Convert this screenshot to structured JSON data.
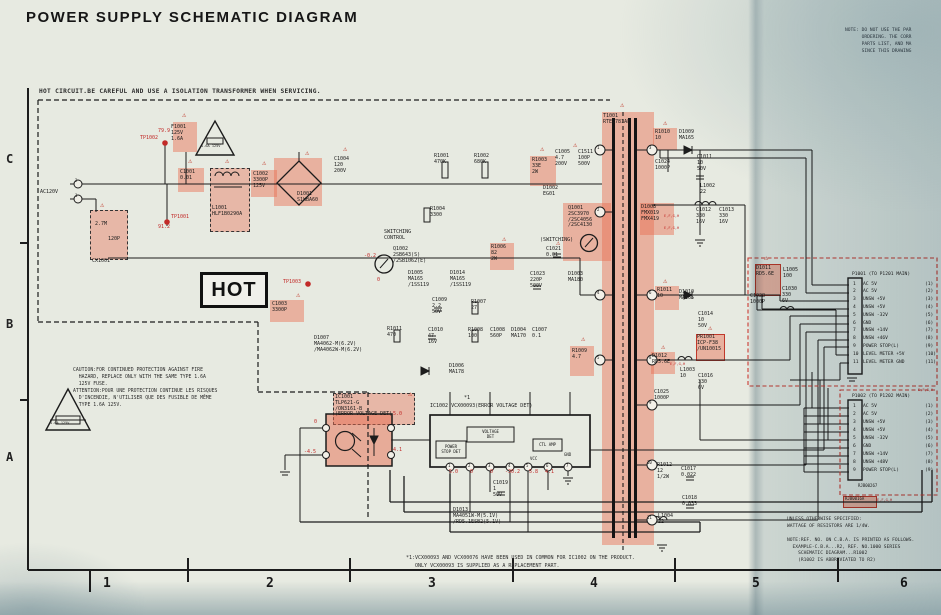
{
  "title": "POWER SUPPLY SCHEMATIC DIAGRAM",
  "corner_note": "NOTE: DO NOT USE THE PAR\n      ORDERING. THE CORR\n      PARTS LIST, AND MA\n      SINCE THIS DRAWING",
  "hot_warning": "HOT CIRCUIT.BE CAREFUL AND USE A ISOLATION TRANSFORMER WHEN SERVICING.",
  "hot_label": "HOT",
  "caution_note": "CAUTION:FOR CONTINUED PROTECTION AGAINST FIRE\n  HAZARD, REPLACE ONLY WITH THE SAME TYPE 1.6A\n  125V FUSE.\nATTENTION:POUR UNE PROTECTION CONTINUE LES RISQUES\n  D'INCENDIE, N'UTILISER QUE DES FUSIBLE DE MÊME\n  TYPE 1.6A 125V.",
  "right_notes": "UNLESS OTHERWISE SPECIFIED:\nWATTAGE OF RESISTORS ARE 1/4W.\n\nNOTE:REF. NO. ON C.B.A. IS PRINTED AS FOLLOWS.\n  EXAMPLE-C.B.A...R2, REF. NO.1000 SERIES\n    SCHEMATIC DIAGRAM...R1002\n    (R1002 IS ABBREVIATED TO R2)",
  "footnote": "*1:VCX00093 AND VCX00076 HAVE BEEN USED IN COMMON FOR IC1002 ON THE PRODUCT.\n   ONLY VCX00093 IS SUPPLIED AS A REPLACEMENT PART.",
  "colors": {
    "highlight": "#e86c50",
    "red_annotation": "#c22a28",
    "red_dashed_box": "#cc3b33",
    "paper": "#e7eae1",
    "line": "#1c1c1c"
  },
  "grid": {
    "rows": [
      "C",
      "B",
      "A"
    ],
    "cols": [
      "1",
      "2",
      "3",
      "4",
      "5",
      "6"
    ]
  },
  "ic1002": {
    "power_stop": "POWER\nSTOP DET",
    "voltage_det": "VOLTAGE\nDET",
    "ctl_amp": "CTL AMP",
    "vcc": "VCC",
    "gnd": "GND"
  },
  "connectors": [
    {
      "header": "P1001 (TO P1201 MAIN)",
      "pins": [
        {
          "n": "1",
          "label": "AC 5V",
          "ref": "(1)"
        },
        {
          "n": "2",
          "label": "AC 5V",
          "ref": "(2)"
        },
        {
          "n": "3",
          "label": "UNSW +5V",
          "ref": "(3)"
        },
        {
          "n": "4",
          "label": "UNSW +5V",
          "ref": "(4)"
        },
        {
          "n": "5",
          "label": "UNSW -32V",
          "ref": "(5)"
        },
        {
          "n": "6",
          "label": "GND",
          "ref": "(6)"
        },
        {
          "n": "7",
          "label": "UNSW +14V",
          "ref": "(7)"
        },
        {
          "n": "8",
          "label": "UNSW +46V",
          "ref": "(8)"
        },
        {
          "n": "9",
          "label": "POWER STOP(L)",
          "ref": "(9)"
        },
        {
          "n": "10",
          "label": "LEVEL METER +5V",
          "ref": "(10)"
        },
        {
          "n": "11",
          "label": "LEVEL METER GND",
          "ref": "(11)"
        }
      ]
    },
    {
      "header": "P1002 (TO P1202 MAIN)",
      "pins": [
        {
          "n": "1",
          "label": "AC 5V",
          "ref": "(1)"
        },
        {
          "n": "2",
          "label": "AC 5V",
          "ref": "(2)"
        },
        {
          "n": "3",
          "label": "UNSW +5V",
          "ref": "(3)"
        },
        {
          "n": "4",
          "label": "UNSW +5V",
          "ref": "(4)"
        },
        {
          "n": "5",
          "label": "UNSW -32V",
          "ref": "(5)"
        },
        {
          "n": "6",
          "label": "GND",
          "ref": "(6)"
        },
        {
          "n": "7",
          "label": "UNSW +14V",
          "ref": "(7)"
        },
        {
          "n": "8",
          "label": "UNSW +48V",
          "ref": "(8)"
        },
        {
          "n": "9",
          "label": "POWER STOP(L)",
          "ref": "(9)"
        }
      ]
    }
  ],
  "highlights": [
    {
      "x": 173,
      "y": 122,
      "w": 24,
      "h": 30
    },
    {
      "x": 178,
      "y": 168,
      "w": 26,
      "h": 24
    },
    {
      "x": 210,
      "y": 168,
      "w": 38,
      "h": 62,
      "bk": 1
    },
    {
      "x": 251,
      "y": 170,
      "w": 26,
      "h": 27
    },
    {
      "x": 274,
      "y": 158,
      "w": 48,
      "h": 48
    },
    {
      "x": 90,
      "y": 210,
      "w": 36,
      "h": 48,
      "bk": 1
    },
    {
      "x": 530,
      "y": 156,
      "w": 26,
      "h": 30
    },
    {
      "x": 563,
      "y": 203,
      "w": 48,
      "h": 58
    },
    {
      "x": 490,
      "y": 243,
      "w": 24,
      "h": 27
    },
    {
      "x": 270,
      "y": 300,
      "w": 34,
      "h": 22
    },
    {
      "x": 570,
      "y": 346,
      "w": 24,
      "h": 30
    },
    {
      "x": 653,
      "y": 128,
      "w": 24,
      "h": 22
    },
    {
      "x": 640,
      "y": 203,
      "w": 34,
      "h": 32
    },
    {
      "x": 655,
      "y": 286,
      "w": 24,
      "h": 24
    },
    {
      "x": 651,
      "y": 352,
      "w": 24,
      "h": 22
    },
    {
      "x": 696,
      "y": 334,
      "w": 27,
      "h": 25,
      "bd": 1
    },
    {
      "x": 755,
      "y": 264,
      "w": 24,
      "h": 30,
      "bd": 1
    },
    {
      "x": 333,
      "y": 393,
      "w": 80,
      "h": 30,
      "bk": 1
    },
    {
      "x": 602,
      "y": 112,
      "w": 52,
      "h": 433
    },
    {
      "x": 843,
      "y": 496,
      "w": 32,
      "h": 10,
      "bd": 1
    }
  ],
  "warning_triangles": [
    {
      "x": 182,
      "y": 112
    },
    {
      "x": 188,
      "y": 158
    },
    {
      "x": 225,
      "y": 158
    },
    {
      "x": 262,
      "y": 160
    },
    {
      "x": 305,
      "y": 150
    },
    {
      "x": 343,
      "y": 146
    },
    {
      "x": 100,
      "y": 202
    },
    {
      "x": 540,
      "y": 146
    },
    {
      "x": 573,
      "y": 142
    },
    {
      "x": 502,
      "y": 236
    },
    {
      "x": 296,
      "y": 292
    },
    {
      "x": 581,
      "y": 336
    },
    {
      "x": 663,
      "y": 120
    },
    {
      "x": 663,
      "y": 278
    },
    {
      "x": 661,
      "y": 344
    },
    {
      "x": 708,
      "y": 325
    },
    {
      "x": 764,
      "y": 255
    },
    {
      "x": 408,
      "y": 391
    },
    {
      "x": 556,
      "y": 240
    },
    {
      "x": 620,
      "y": 102
    }
  ],
  "labels": [
    {
      "x": 40,
      "y": 190,
      "t": "AC120V"
    },
    {
      "x": 75,
      "y": 179,
      "t": "2",
      "s": 4
    },
    {
      "x": 75,
      "y": 194,
      "t": "1",
      "s": 4
    },
    {
      "x": 171,
      "y": 125,
      "t": "F1001\n125V\n1.6A"
    },
    {
      "x": 201,
      "y": 144,
      "t": "1.6A 125V",
      "s": 35
    },
    {
      "x": 180,
      "y": 170,
      "t": "C1001\n0.01"
    },
    {
      "x": 212,
      "y": 206,
      "t": "L1001\nHLF1B0290A"
    },
    {
      "x": 253,
      "y": 172,
      "t": "C1002\n3300P\n125V"
    },
    {
      "x": 297,
      "y": 192,
      "t": "D1001\nS1WBA60"
    },
    {
      "x": 334,
      "y": 157,
      "t": "C1004\n120\n200V"
    },
    {
      "x": 95,
      "y": 222,
      "t": "2.7M"
    },
    {
      "x": 108,
      "y": 237,
      "t": "120P"
    },
    {
      "x": 92,
      "y": 259,
      "t": "CX1001"
    },
    {
      "x": 434,
      "y": 154,
      "t": "R1001\n470K"
    },
    {
      "x": 474,
      "y": 154,
      "t": "R1002\n680K"
    },
    {
      "x": 532,
      "y": 158,
      "t": "R1003\n33E\n2W"
    },
    {
      "x": 555,
      "y": 150,
      "t": "C1005\n4.7\n200V"
    },
    {
      "x": 578,
      "y": 150,
      "t": "C1511\n100P\n500V"
    },
    {
      "x": 543,
      "y": 186,
      "t": "D1002\nEG01"
    },
    {
      "x": 568,
      "y": 206,
      "t": "Q1001\n2SC3970\n/2SC4056\n/2SC4130"
    },
    {
      "x": 540,
      "y": 238,
      "t": "(SWITCHING)"
    },
    {
      "x": 430,
      "y": 207,
      "t": "R1004\n3300"
    },
    {
      "x": 384,
      "y": 230,
      "t": "SWITCHING\nCONTROL"
    },
    {
      "x": 393,
      "y": 247,
      "t": "Q1002\n2SB643(S)\n/2SB1062(E)"
    },
    {
      "x": 408,
      "y": 271,
      "t": "D1005\nMA165\n/1SS119"
    },
    {
      "x": 450,
      "y": 271,
      "t": "D1014\nMA165\n/1SS119"
    },
    {
      "x": 491,
      "y": 245,
      "t": "R1006\n82\n2W"
    },
    {
      "x": 432,
      "y": 298,
      "t": "C1009\n2.2\n50V"
    },
    {
      "x": 471,
      "y": 300,
      "t": "R1007\n27"
    },
    {
      "x": 428,
      "y": 328,
      "t": "C1010\n47\n16V"
    },
    {
      "x": 468,
      "y": 328,
      "t": "R1008\n100"
    },
    {
      "x": 490,
      "y": 328,
      "t": "C1008\n560P"
    },
    {
      "x": 511,
      "y": 328,
      "t": "D1004\nMA170"
    },
    {
      "x": 532,
      "y": 328,
      "t": "C1007\n0.1"
    },
    {
      "x": 449,
      "y": 364,
      "t": "D1006\nMA178"
    },
    {
      "x": 572,
      "y": 349,
      "t": "R1009\n4.7"
    },
    {
      "x": 387,
      "y": 327,
      "t": "R1011\n470"
    },
    {
      "x": 314,
      "y": 336,
      "t": "D1007\nMA4062-M(6.2V)\n/MA4062W-M(6.2V)"
    },
    {
      "x": 272,
      "y": 302,
      "t": "C1003\n3300P"
    },
    {
      "x": 546,
      "y": 247,
      "t": "C1021\n0.01"
    },
    {
      "x": 530,
      "y": 272,
      "t": "C1023\n220P\n500V"
    },
    {
      "x": 568,
      "y": 272,
      "t": "D1003\nMA180"
    },
    {
      "x": 603,
      "y": 114,
      "t": "T1001\nRTE1781AF"
    },
    {
      "x": 655,
      "y": 130,
      "t": "R1010\n10"
    },
    {
      "x": 679,
      "y": 130,
      "t": "D1009\nMA165"
    },
    {
      "x": 697,
      "y": 155,
      "t": "C1011\n10\n50V"
    },
    {
      "x": 655,
      "y": 160,
      "t": "C1024\n1000P"
    },
    {
      "x": 700,
      "y": 184,
      "t": "L1002\n22"
    },
    {
      "x": 696,
      "y": 208,
      "t": "C1012\n330\n16V"
    },
    {
      "x": 719,
      "y": 208,
      "t": "C1013\n330\n16V"
    },
    {
      "x": 641,
      "y": 205,
      "t": "D1008\nFMX019\nFMX419"
    },
    {
      "x": 664,
      "y": 214,
      "t": "E,F,G,H",
      "c": 1,
      "s": 35
    },
    {
      "x": 664,
      "y": 226,
      "t": "E,F,G,H",
      "c": 1,
      "s": 35
    },
    {
      "x": 657,
      "y": 288,
      "t": "R1011\n10"
    },
    {
      "x": 679,
      "y": 290,
      "t": "D1010\nMA165"
    },
    {
      "x": 698,
      "y": 312,
      "t": "C1014\n10\n50V"
    },
    {
      "x": 697,
      "y": 335,
      "t": "PR1001\nICP-F38\n/UN10015"
    },
    {
      "x": 652,
      "y": 354,
      "t": "D1012\nRD5.6E"
    },
    {
      "x": 670,
      "y": 362,
      "t": "E,F,G,H",
      "c": 1,
      "s": 35
    },
    {
      "x": 680,
      "y": 368,
      "t": "L1003\n10"
    },
    {
      "x": 698,
      "y": 374,
      "t": "C1016\n330\n6V"
    },
    {
      "x": 654,
      "y": 390,
      "t": "C1025\n1000P"
    },
    {
      "x": 756,
      "y": 266,
      "t": "D1011\nRD5.6E"
    },
    {
      "x": 783,
      "y": 268,
      "t": "L1005\n100"
    },
    {
      "x": 782,
      "y": 287,
      "t": "C1030\n330\n6V"
    },
    {
      "x": 750,
      "y": 294,
      "t": "C1028\n1000P"
    },
    {
      "x": 657,
      "y": 463,
      "t": "R1012\n12\n1/2W"
    },
    {
      "x": 681,
      "y": 467,
      "t": "C1017\n0.022"
    },
    {
      "x": 682,
      "y": 496,
      "t": "C1018\n0.033"
    },
    {
      "x": 658,
      "y": 514,
      "t": "L1004\n22"
    },
    {
      "x": 453,
      "y": 508,
      "t": "D1013\nMA4051W-M(5.1V)\n/RD5.1ESB2(5.1V)"
    },
    {
      "x": 493,
      "y": 481,
      "t": "C1019\n1\n50V"
    },
    {
      "x": 335,
      "y": 395,
      "t": "IC1001\nTLP621-G\n/ON3161-B\n(ERROR VOLTAGE DET)"
    },
    {
      "x": 430,
      "y": 404,
      "t": "IC1002 VCX00093(ERROR VOLTAGE DET)"
    },
    {
      "x": 464,
      "y": 396,
      "t": "*1"
    },
    {
      "x": 858,
      "y": 484,
      "t": "RJB00267",
      "s": 4
    },
    {
      "x": 845,
      "y": 497,
      "t": "RJB0016A",
      "s": 4
    },
    {
      "x": 877,
      "y": 498,
      "t": "E,F,G,H",
      "c": 1,
      "s": 35
    },
    {
      "x": 918,
      "y": 388,
      "t": "E,F,G,H",
      "c": 1,
      "s": 35
    },
    {
      "x": 50,
      "y": 421,
      "t": "1.6A 125V",
      "s": 35
    },
    {
      "x": 140,
      "y": 136,
      "t": "TP1002",
      "c": 1
    },
    {
      "x": 158,
      "y": 129,
      "t": "79.9",
      "c": 1
    },
    {
      "x": 171,
      "y": 215,
      "t": "TP1001",
      "c": 1
    },
    {
      "x": 158,
      "y": 225,
      "t": "91.2",
      "c": 1
    },
    {
      "x": 283,
      "y": 280,
      "t": "TP1003",
      "c": 1
    },
    {
      "x": 364,
      "y": 254,
      "t": "-0.2",
      "c": 1
    },
    {
      "x": 377,
      "y": 278,
      "t": "0",
      "c": 1
    },
    {
      "x": 449,
      "y": 470,
      "t": "5.0",
      "c": 1
    },
    {
      "x": 470,
      "y": 470,
      "t": "0",
      "c": 1
    },
    {
      "x": 490,
      "y": 470,
      "t": "0",
      "c": 1
    },
    {
      "x": 505,
      "y": 470,
      "t": "-30.2",
      "c": 1
    },
    {
      "x": 529,
      "y": 470,
      "t": "5.8",
      "c": 1
    },
    {
      "x": 545,
      "y": 470,
      "t": "4.1",
      "c": 1
    },
    {
      "x": 393,
      "y": 412,
      "t": "5.0",
      "c": 1
    },
    {
      "x": 393,
      "y": 448,
      "t": "4.1",
      "c": 1
    },
    {
      "x": 304,
      "y": 450,
      "t": "-4.5",
      "c": 1
    },
    {
      "x": 314,
      "y": 420,
      "t": "0",
      "c": 1
    },
    {
      "x": 597,
      "y": 146,
      "t": "1",
      "s": 4
    },
    {
      "x": 597,
      "y": 208,
      "t": "2",
      "s": 4
    },
    {
      "x": 597,
      "y": 291,
      "t": "4",
      "s": 4
    },
    {
      "x": 597,
      "y": 356,
      "t": "5",
      "s": 4
    },
    {
      "x": 649,
      "y": 146,
      "t": "3",
      "s": 4
    },
    {
      "x": 649,
      "y": 291,
      "t": "6",
      "s": 4
    },
    {
      "x": 649,
      "y": 356,
      "t": "8",
      "s": 4
    },
    {
      "x": 649,
      "y": 401,
      "t": "9",
      "s": 4
    },
    {
      "x": 647,
      "y": 461,
      "t": "10",
      "s": 4
    },
    {
      "x": 647,
      "y": 516,
      "t": "11",
      "s": 4
    },
    {
      "x": 448,
      "y": 464,
      "t": "1",
      "s": 4
    },
    {
      "x": 468,
      "y": 464,
      "t": "2",
      "s": 4
    },
    {
      "x": 488,
      "y": 464,
      "t": "3",
      "s": 4
    },
    {
      "x": 508,
      "y": 464,
      "t": "4",
      "s": 4
    },
    {
      "x": 526,
      "y": 464,
      "t": "5",
      "s": 4
    },
    {
      "x": 546,
      "y": 464,
      "t": "6",
      "s": 4
    },
    {
      "x": 566,
      "y": 464,
      "t": "7",
      "s": 4
    },
    {
      "x": 530,
      "y": 457,
      "t": "VCC",
      "s": 4
    },
    {
      "x": 564,
      "y": 453,
      "t": "GND",
      "s": 4
    }
  ]
}
